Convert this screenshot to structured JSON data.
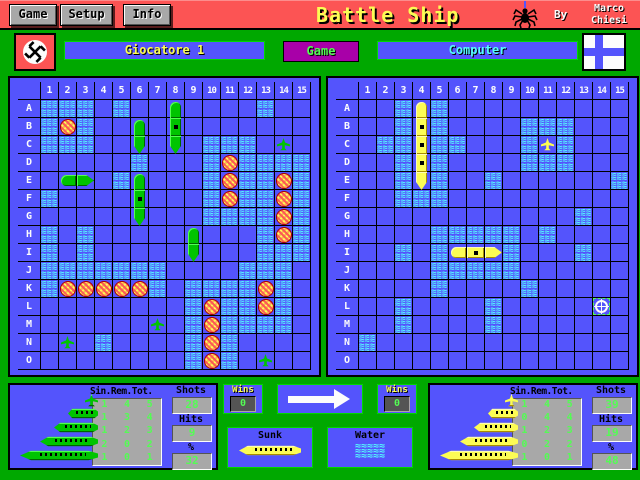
{
  "title_bar": {
    "buttons": [
      "Game",
      "Setup",
      "Info"
    ],
    "title": "Battle Ship",
    "by_label": "By",
    "author_line1": "Marco",
    "author_line2": "Chiesi"
  },
  "players_bar": {
    "player1": "Giocatore 1",
    "game_button": "Game",
    "player2": "Computer"
  },
  "colors": {
    "background_green": "#00a800",
    "titlebar_red": "#fc5454",
    "board_blue": "#5454fc",
    "water_cyan": "#54fcfc",
    "text_yellow": "#fcfc54",
    "magenta_button": "#a800a8",
    "digit_green": "#54fc54",
    "player_ship": "green",
    "computer_ship": "yellow"
  },
  "left_grid": {
    "owner": "Giocatore 1",
    "ship_color": "green",
    "col_headers": [
      "1",
      "2",
      "3",
      "4",
      "5",
      "6",
      "7",
      "8",
      "9",
      "10",
      "11",
      "12",
      "13",
      "14",
      "15"
    ],
    "row_headers": [
      "A",
      "B",
      "C",
      "D",
      "E",
      "F",
      "G",
      "H",
      "I",
      "J",
      "K",
      "L",
      "M",
      "N",
      "O"
    ],
    "cells": [
      "www.w..t....w..",
      "wxw..t.m.......",
      "www..b.b.www.p.",
      ".....w...wxwwww",
      ".lr.wt...wxwwxw",
      "w....m...wxwwxw",
      ".....b...wwwwxw",
      "w.w.....t...wxw",
      "w.w.....b...www",
      "wwwwwww....www.",
      "wxxxxxw.wwwwxw.",
      "........wxwwxw.",
      "......p.wxwwww.",
      ".p.w....wxw....",
      "........wxw.p.."
    ]
  },
  "right_grid": {
    "owner": "Computer",
    "ship_color": "yellow",
    "col_headers": [
      "1",
      "2",
      "3",
      "4",
      "5",
      "6",
      "7",
      "8",
      "9",
      "10",
      "11",
      "12",
      "13",
      "14",
      "15"
    ],
    "row_headers": [
      "A",
      "B",
      "C",
      "D",
      "E",
      "F",
      "G",
      "H",
      "I",
      "J",
      "K",
      "L",
      "M",
      "N",
      "O"
    ],
    "cells": [
      "..wtw..........",
      "..wmw....www...",
      ".wwmww...wpw...",
      "..wmw....www...",
      "..wbw..w......w",
      "..www..........",
      "............w..",
      "....wwwww.w....",
      "..w.wlcrw...w..",
      "....wwwww......",
      "....w....w.....",
      "..w....w.....+.",
      "..w....w.......",
      "w..............",
      "..............."
    ]
  },
  "left_panel": {
    "table_header": "Sin.Rem.Tot.",
    "fleet_rows": [
      {
        "ship_size": 1,
        "sin": "1",
        "rem": "4",
        "tot": "5"
      },
      {
        "ship_size": 2,
        "sin": "1",
        "rem": "3",
        "tot": "4"
      },
      {
        "ship_size": 3,
        "sin": "1",
        "rem": "2",
        "tot": "3"
      },
      {
        "ship_size": 4,
        "sin": "2",
        "rem": "0",
        "tot": "2"
      },
      {
        "ship_size": 5,
        "sin": "1",
        "rem": "0",
        "tot": "1"
      }
    ],
    "shots_label": "Shots",
    "shots": "28",
    "hits_label": "Hits",
    "hits": "9",
    "percent_label": "%",
    "percent": "32"
  },
  "right_panel": {
    "table_header": "Sin.Rem.Tot.",
    "fleet_rows": [
      {
        "ship_size": 1,
        "sin": "1",
        "rem": "4",
        "tot": "5"
      },
      {
        "ship_size": 2,
        "sin": "0",
        "rem": "4",
        "tot": "4"
      },
      {
        "ship_size": 3,
        "sin": "1",
        "rem": "2",
        "tot": "3"
      },
      {
        "ship_size": 4,
        "sin": "0",
        "rem": "2",
        "tot": "2"
      },
      {
        "ship_size": 5,
        "sin": "1",
        "rem": "0",
        "tot": "1"
      }
    ],
    "shots_label": "Shots",
    "shots": "39",
    "hits_label": "Hits",
    "hits": "19",
    "percent_label": "%",
    "percent": "48"
  },
  "center": {
    "wins_label": "Wins",
    "wins_left": "0",
    "wins_right": "0",
    "sunk_label": "Sunk",
    "water_label": "Water"
  }
}
